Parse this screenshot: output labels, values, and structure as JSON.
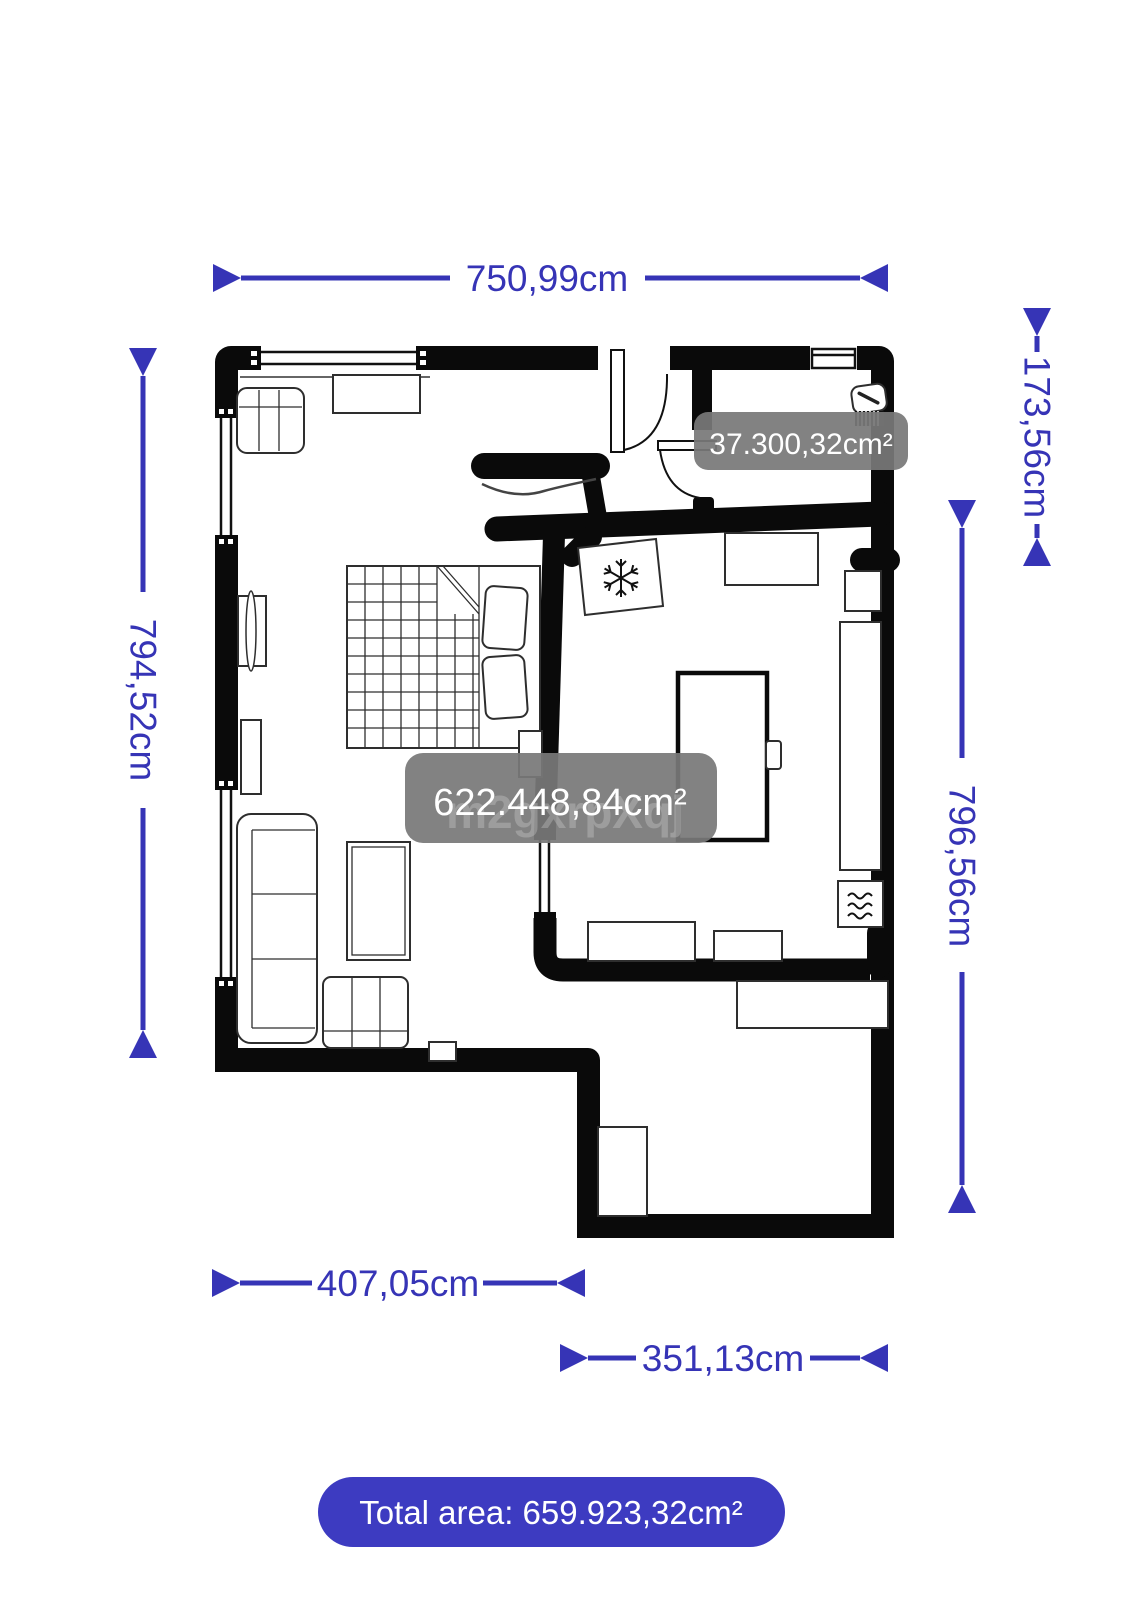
{
  "dimensions": {
    "top": "750,99cm",
    "left": "794,52cm",
    "right_upper": "173,56cm",
    "right": "796,56cm",
    "bottom_left": "407,05cm",
    "bottom_right": "351,13cm"
  },
  "room_labels": {
    "main": "622.448,84cm²",
    "bathroom": "37.300,32cm²"
  },
  "watermark": "m2gxrpXqj",
  "total_area": "Total area: 659.923,32cm²",
  "colors": {
    "dimension_blue": "#3634b6",
    "total_pill_blue": "#3d3bc1",
    "room_label_gray": "#787878",
    "wall_black": "#0a0a0a",
    "background": "#ffffff"
  },
  "icons": {
    "snowflake": "refrigerator",
    "waves": "washing-machine",
    "sink": "bathroom-sink"
  }
}
